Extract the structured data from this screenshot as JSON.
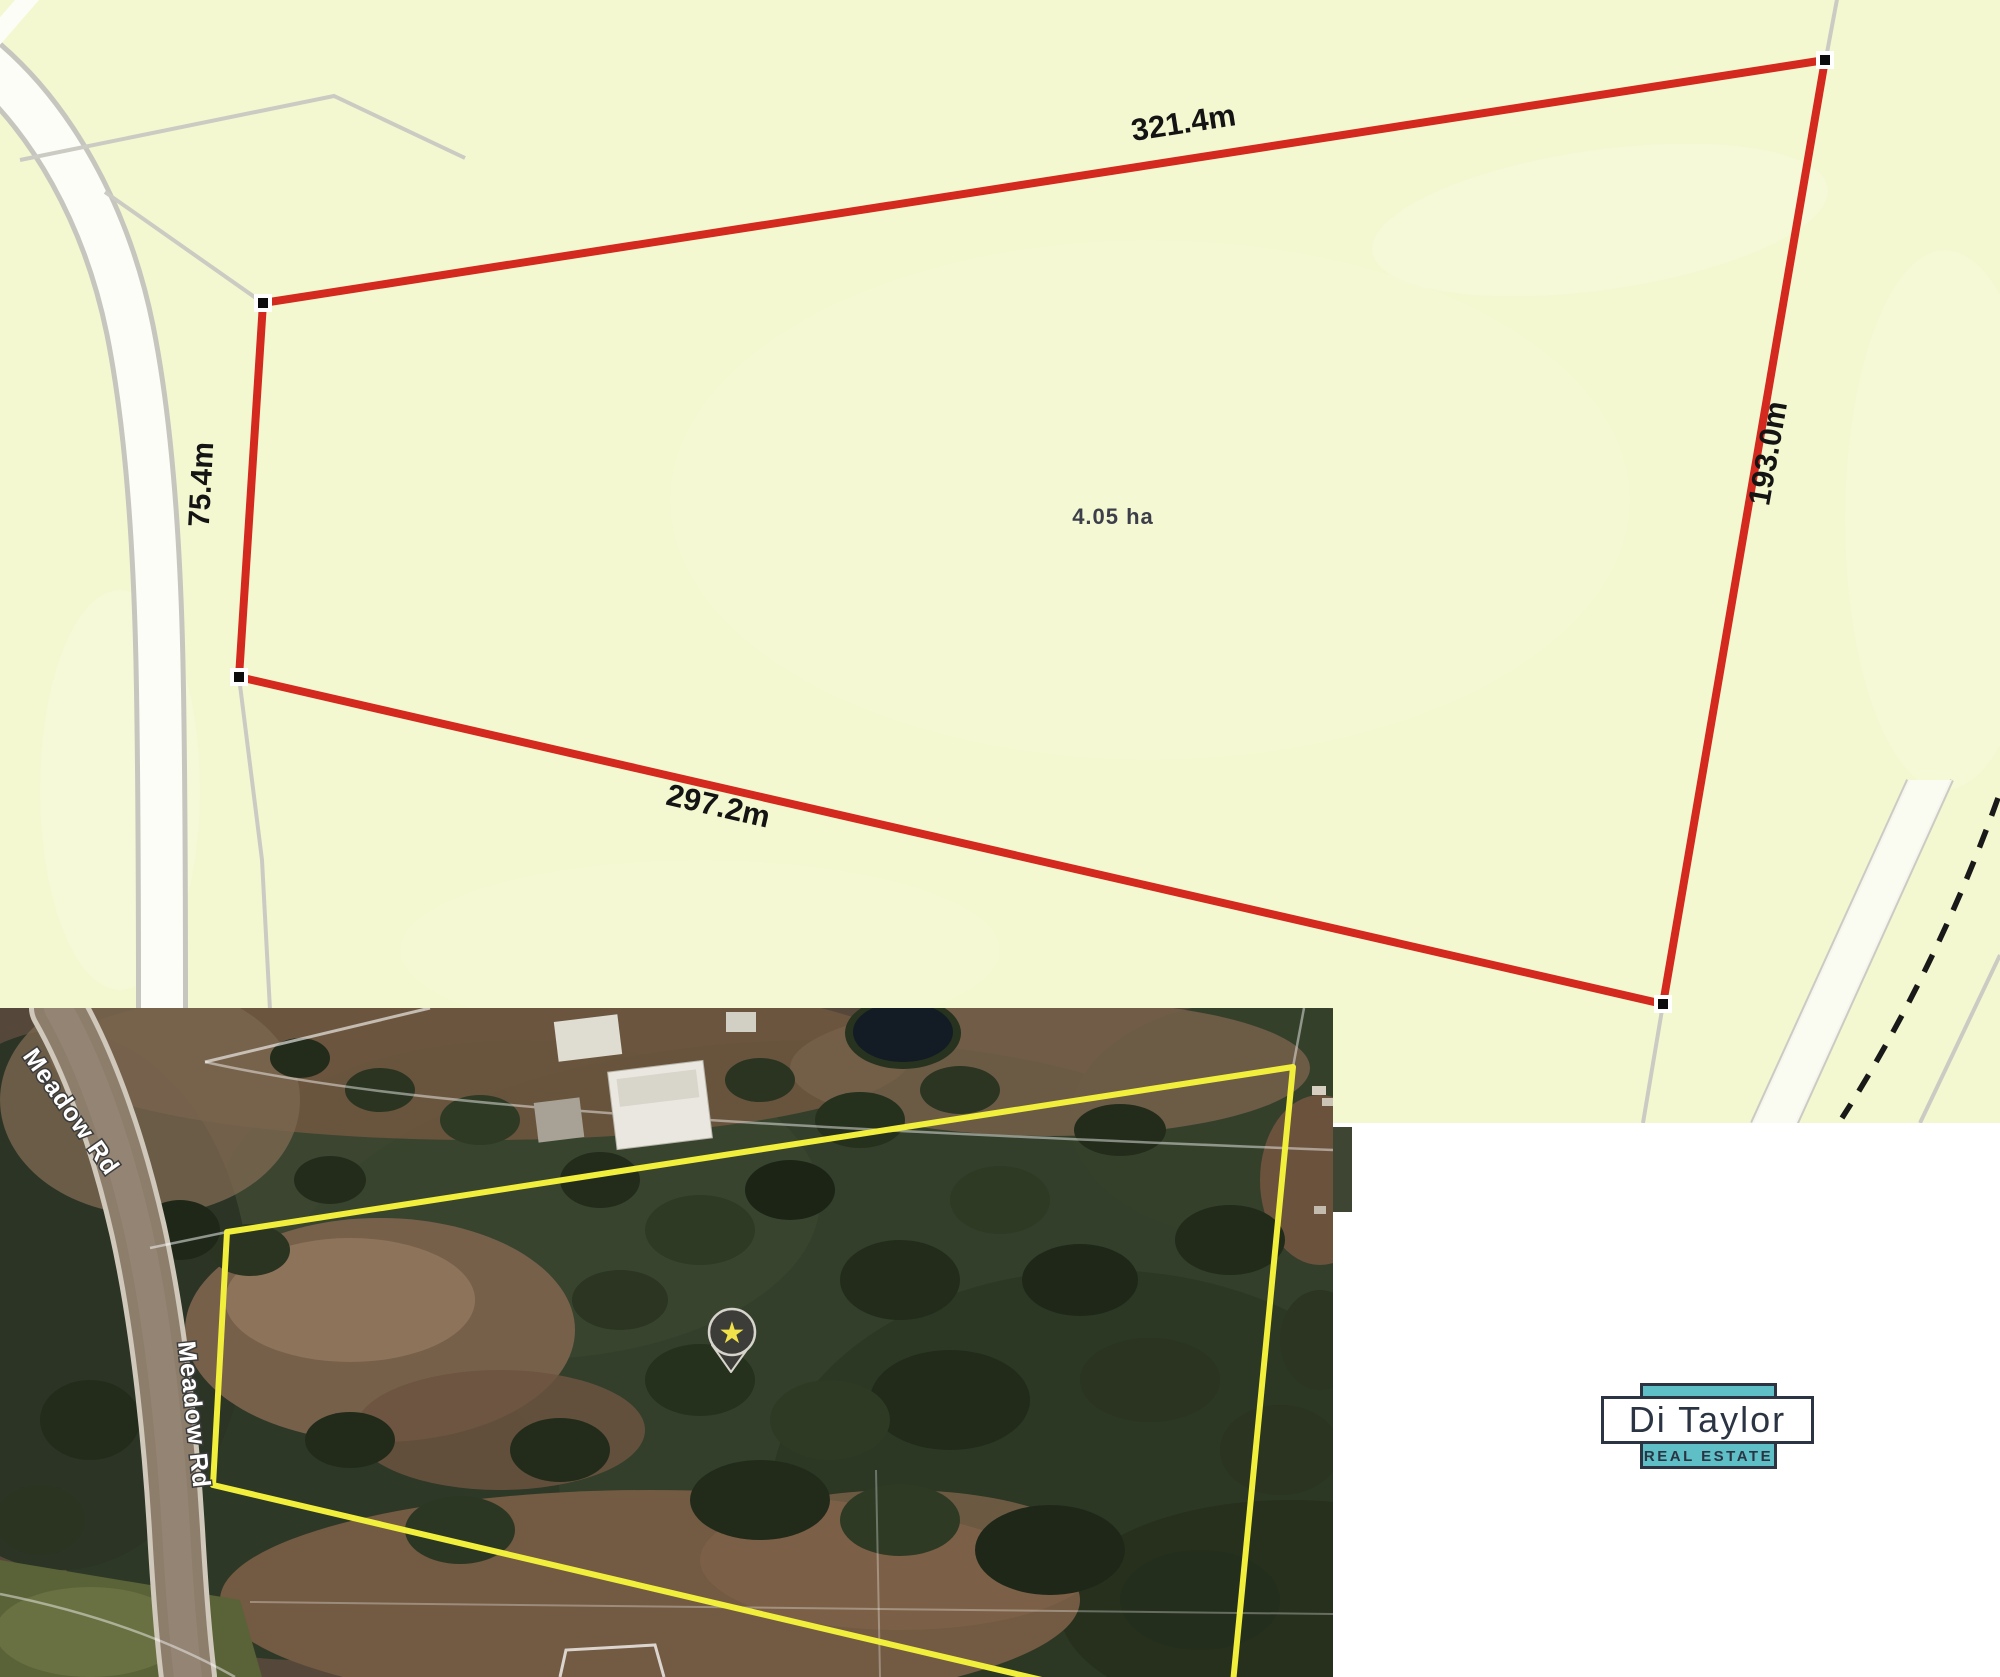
{
  "plan_map": {
    "background_color": "#f4f8d0",
    "boundary_color": "#d4291e",
    "area_label": "4.05 ha",
    "side_labels": {
      "north": "321.4m",
      "east": "193.0m",
      "south": "297.2m",
      "west": "75.4m"
    }
  },
  "satellite_map": {
    "boundary_color": "#f2ee3c",
    "road_label_top": "Meadow Rd",
    "road_label_left": "Meadow Rd",
    "marker": {
      "name": "star-marker",
      "glyph": "★",
      "star_color": "#f0e04a"
    }
  },
  "logo": {
    "brand": "Di Taylor",
    "tagline": "REAL ESTATE",
    "teal_color": "#5fbfc7",
    "navy_color": "#2b3443"
  }
}
